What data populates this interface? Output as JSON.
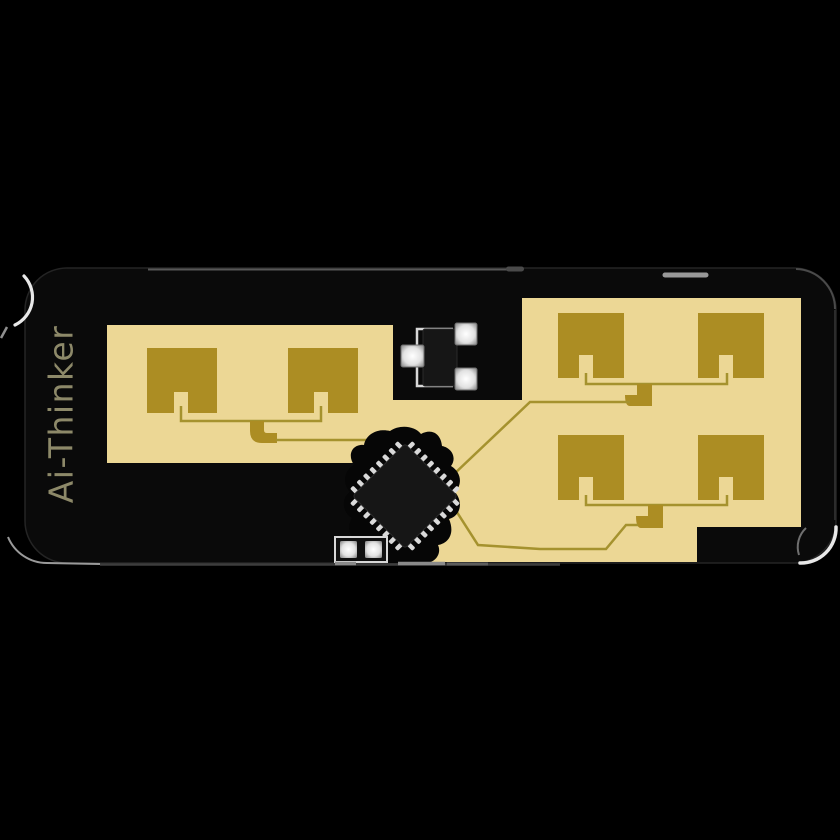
{
  "board": {
    "brand_label": "Ai-Thinker",
    "left_array_patch_count": 2,
    "right_array_patch_count": 4,
    "colors": {
      "background": "#000000",
      "board_black": "#0a0a0a",
      "substrate_tan": "#ecd795",
      "patch_gold": "#ac8d23",
      "trace_gold": "#a5922e",
      "chip_black": "#161616",
      "pin_silver": "#d9d9d9",
      "silkscreen_white": "#d8d8d8",
      "brand_text": "#8d8969",
      "edge_highlight": "#e8e8e8"
    }
  }
}
